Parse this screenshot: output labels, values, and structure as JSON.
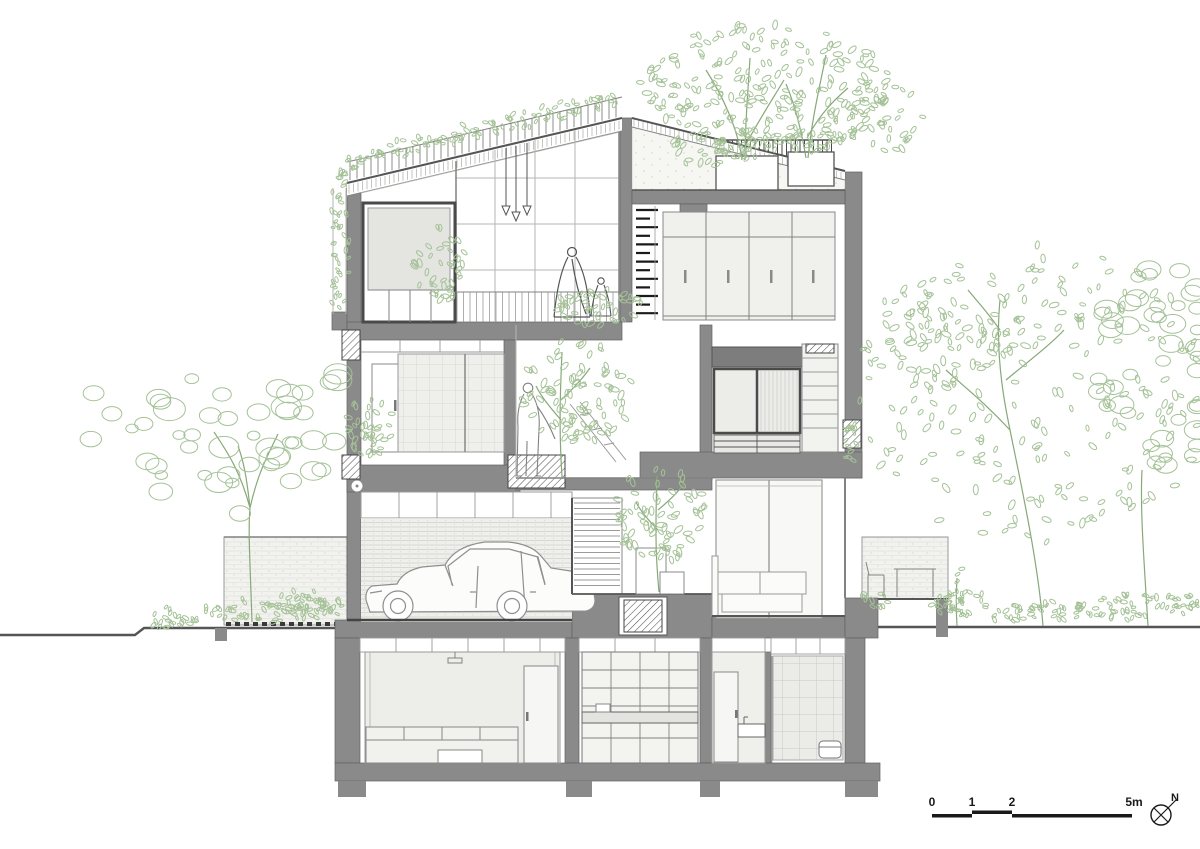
{
  "scale_bar": {
    "labels": [
      "0",
      "1",
      "2",
      "5m"
    ]
  },
  "compass": {
    "label": "N"
  },
  "colors": {
    "wall": "#8a8a8a",
    "frame": "#4a4a4a",
    "green": "#a5c297",
    "green2": "#87a878",
    "ink": "#1a1a1a"
  }
}
